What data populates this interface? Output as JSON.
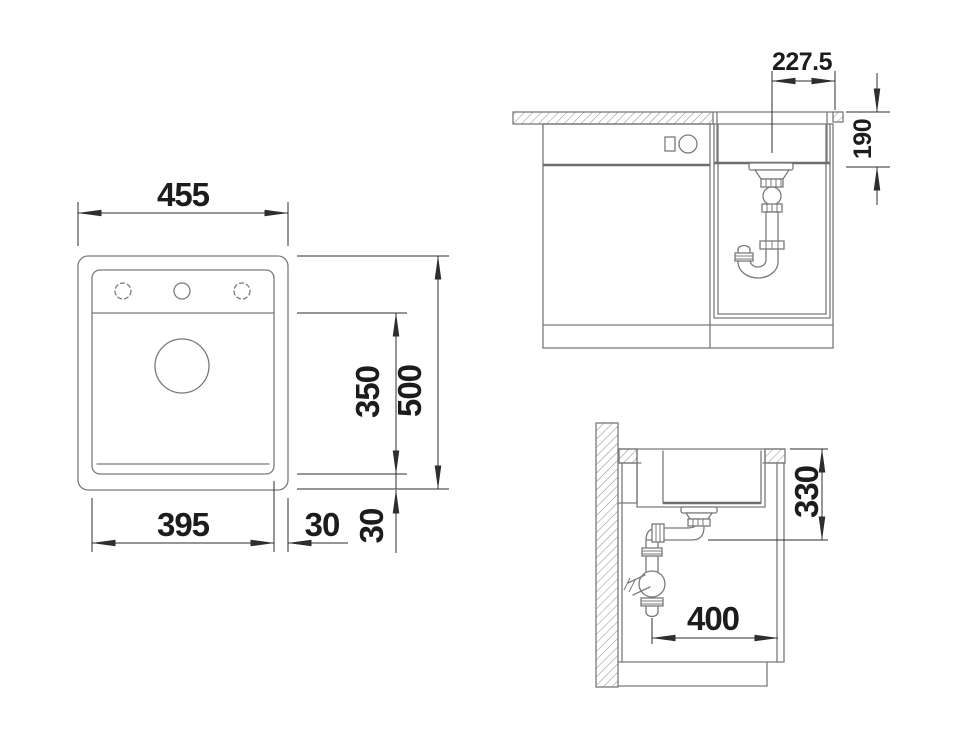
{
  "drawing": {
    "title": "sink-installation-technical-drawing",
    "background": "#ffffff",
    "colors": {
      "geometry_line": "#7a7a7a",
      "dimension_line": "#2e2e2e",
      "dimension_text": "#1c1c1c"
    },
    "views": {
      "plan": {
        "dimensions": {
          "overall_width": "455",
          "overall_depth": "500",
          "bowl_depth": "350",
          "bowl_width": "395",
          "side_rim": "30",
          "front_rim": "30"
        }
      },
      "front": {
        "dimensions": {
          "drain_center_offset": "227.5",
          "bowl_depth": "190"
        }
      },
      "side": {
        "dimensions": {
          "counter_to_trap": "330",
          "trap_clearance": "400"
        }
      }
    }
  }
}
